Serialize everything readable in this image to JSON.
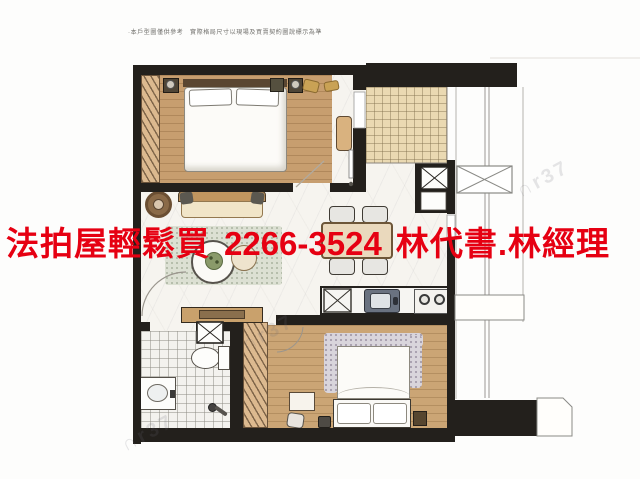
{
  "ad": {
    "text_left": "法拍屋輕鬆買",
    "phone": "2266-3524",
    "text_right": "林代書.林經理",
    "color": "#e60012"
  },
  "caption": {
    "text": "·本戶型圖僅供參考　實際格局尺寸以現場及買賣契約圖說標示為準"
  },
  "watermark": {
    "text": "∩r37"
  },
  "colors": {
    "ad_red": "#e60012",
    "wall_black": "#23201c",
    "wood_floor": "#c79e6f",
    "closet_tan": "#dcb98f",
    "warm_tile": "#ead9b2",
    "white_tile": "#f3f2ee",
    "marble": "#f6f4ef",
    "rug_green": "#dce0d3",
    "sofa_tan": "#c0955f"
  }
}
